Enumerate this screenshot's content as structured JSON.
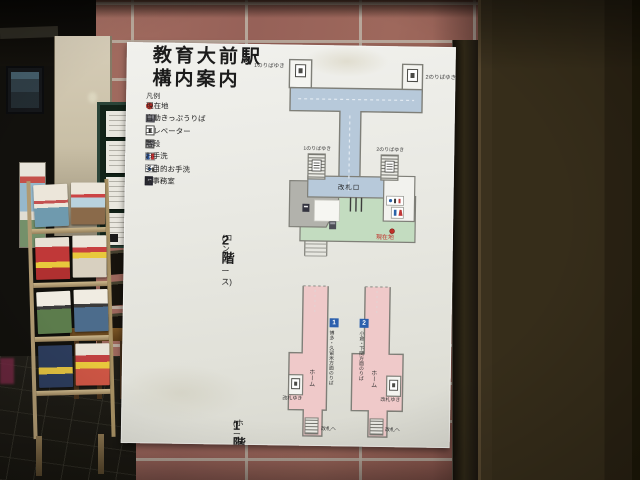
{
  "sign": {
    "title_line1": "教育大前駅",
    "title_line2": "構内案内",
    "legend": {
      "heading": "凡例",
      "items": [
        {
          "icon": "current-location-dot",
          "label": "現在地"
        },
        {
          "icon": "ticket-machine-icon",
          "label": "自動きっぷうりば"
        },
        {
          "icon": "elevator-icon",
          "label": "エレベーター"
        },
        {
          "icon": "stairs-icon",
          "label": "階段"
        },
        {
          "icon": "restroom-icon",
          "label": "お手洗"
        },
        {
          "icon": "accessible-restroom-icon",
          "label": "多目的お手洗"
        },
        {
          "icon": "station-office-icon",
          "label": "駅事務室"
        }
      ]
    },
    "floor2": {
      "floor_label": "2階",
      "floor_label_sub": "(コンコース)",
      "bridge_left_label": "1のりばゆき",
      "bridge_right_label": "2のりばゆき",
      "stairs_left_label": "1のりばゆき",
      "stairs_right_label": "2のりばゆき",
      "ticket_gate_label": "改札口",
      "current_location_label": "現在地"
    },
    "floor1": {
      "floor_label": "1階",
      "floor_label_sub": "(ホーム)",
      "platforms": [
        {
          "number": "1",
          "direction": "博多・久留米方面のりば",
          "platform_label": "ホーム",
          "elevator_note": "改札ゆき",
          "stairs_note": "改札へ"
        },
        {
          "number": "2",
          "direction": "小倉・下関方面のりば",
          "platform_label": "ホーム",
          "elevator_note": "改札ゆき",
          "stairs_note": "改札へ"
        }
      ]
    },
    "colors": {
      "walkway_blue": "#b7c9da",
      "concourse_green": "#c3dcc0",
      "platform_pink": "#efc9c9",
      "office_gray": "#b2b2ac",
      "current_location_red": "#c03028",
      "platform_badge_blue": "#2b5fad"
    }
  }
}
